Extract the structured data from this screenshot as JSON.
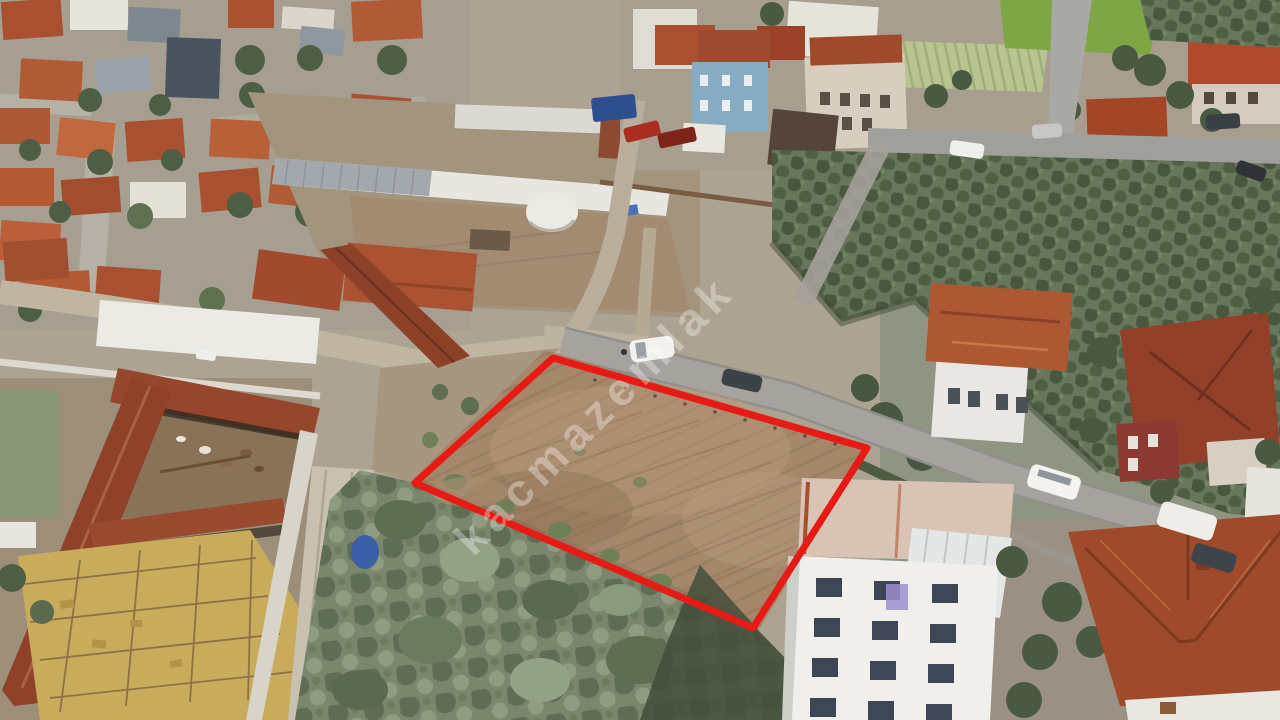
{
  "scene": {
    "type": "aerial-drone-photo",
    "subject": "vacant land plot outlined in red in a residential neighborhood with olive groves and a farm"
  },
  "watermark": {
    "text": "kacmazemlak",
    "color": "#ffffff",
    "opacity": "0.33"
  },
  "plot_outline": {
    "points": "553,358 867,448 753,628 415,483",
    "color": "#e81a15",
    "stroke_width": "7"
  },
  "palette": {
    "plot_dirt": "#a5876b",
    "olive_grove": "#68775b",
    "scrub": "#7a876d",
    "paved_road": "#a6a39e",
    "dirt_road": "#c0b5a1",
    "tile_roof": "#a8502f",
    "hay_yard": "#c9ab5c",
    "white_walls": "#eeece7"
  }
}
